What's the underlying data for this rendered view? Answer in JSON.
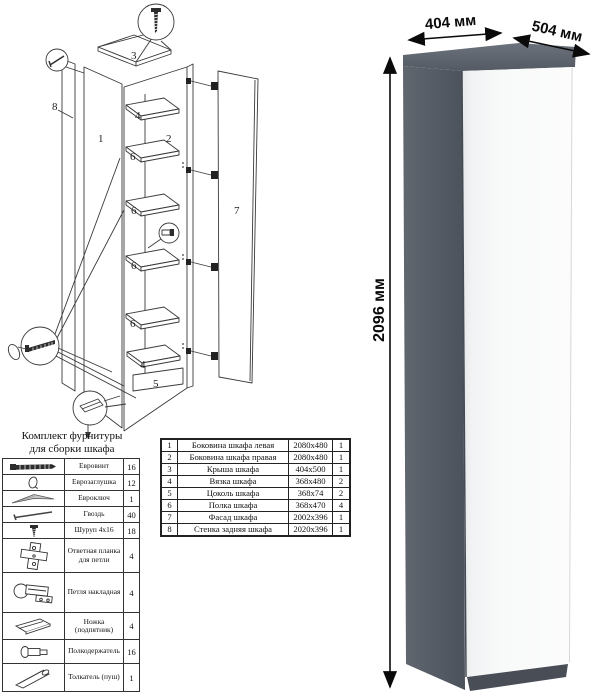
{
  "render": {
    "width_label": "404 мм",
    "depth_label": "504 мм",
    "height_label": "2096 мм",
    "colors": {
      "side": "#565C66",
      "top": "#646B75",
      "door": "#F6F7F8",
      "plinth": "#484D56",
      "line_art": "#3A3A3A"
    }
  },
  "diagram": {
    "part_labels": [
      "3",
      "8",
      "1",
      "4",
      "2",
      "6",
      "6",
      "6",
      "6",
      "7",
      "4",
      "5"
    ]
  },
  "furniture_kit": {
    "title_line1": "Комплект фурнитуры",
    "title_line2": "для сборки шкафа",
    "rows": [
      {
        "icon": "euro-screw-icon",
        "name": "Евровинт",
        "qty": "16"
      },
      {
        "icon": "euro-cap-icon",
        "name": "Еврозаглушка",
        "qty": "12"
      },
      {
        "icon": "hex-key-icon",
        "name": "Евроключ",
        "qty": "1"
      },
      {
        "icon": "nail-icon",
        "name": "Гвоздь",
        "qty": "40"
      },
      {
        "icon": "screw-icon",
        "name": "Шуруп 4x16",
        "qty": "18"
      },
      {
        "icon": "hinge-plate-icon",
        "name": "Ответная планка для петли",
        "qty": "4"
      },
      {
        "icon": "hinge-icon",
        "name": "Петля накладная",
        "qty": "4"
      },
      {
        "icon": "foot-icon",
        "name": "Ножка (подпятник)",
        "qty": "4"
      },
      {
        "icon": "shelf-pin-icon",
        "name": "Полкодержатель",
        "qty": "16"
      },
      {
        "icon": "push-latch-icon",
        "name": "Толкатель (пуш)",
        "qty": "1"
      }
    ]
  },
  "parts_table": {
    "rows": [
      {
        "num": "1",
        "name": "Боковина шкафа левая",
        "size": "2080x480",
        "qty": "1"
      },
      {
        "num": "2",
        "name": "Боковина шкафа правая",
        "size": "2080x480",
        "qty": "1"
      },
      {
        "num": "3",
        "name": "Крыша шкафа",
        "size": "404x500",
        "qty": "1"
      },
      {
        "num": "4",
        "name": "Вязка шкафа",
        "size": "368x480",
        "qty": "2"
      },
      {
        "num": "5",
        "name": "Цоколь шкафа",
        "size": "368x74",
        "qty": "2"
      },
      {
        "num": "6",
        "name": "Полка шкафа",
        "size": "368x470",
        "qty": "4"
      },
      {
        "num": "7",
        "name": "Фасад шкафа",
        "size": "2002x396",
        "qty": "1"
      },
      {
        "num": "8",
        "name": "Стенка задняя шкафа",
        "size": "2020x396",
        "qty": "1"
      }
    ]
  }
}
